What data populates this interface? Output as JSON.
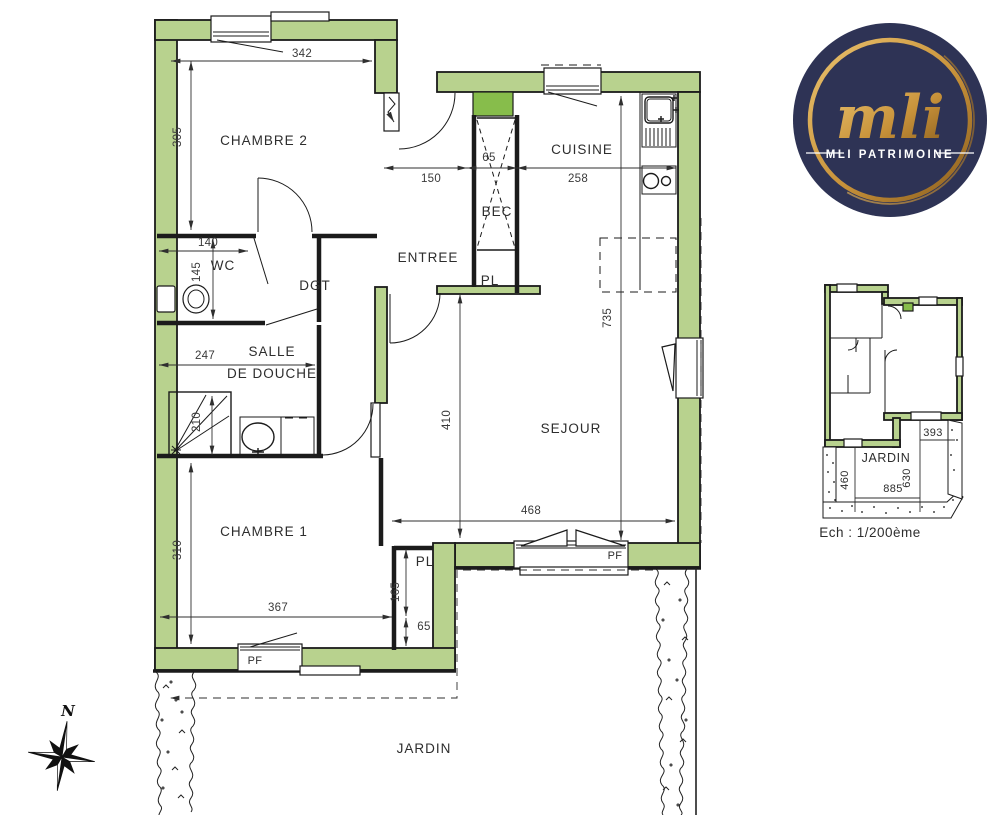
{
  "plan": {
    "rooms": {
      "chambre2": "CHAMBRE 2",
      "wc": "WC",
      "dgt": "DGT",
      "entree": "ENTREE",
      "bec": "BEC",
      "cuisine": "CUISINE",
      "salle": "SALLE",
      "de_douche": "DE DOUCHE",
      "sejour": "SEJOUR",
      "chambre1": "CHAMBRE 1",
      "jardin": "JARDIN"
    },
    "tags": {
      "pl": "PL",
      "pf": "PF"
    },
    "dims": {
      "chambre2_w": "342",
      "chambre2_h": "305",
      "wc_w": "140",
      "wc_h": "145",
      "douche_w": "247",
      "douche_h": "210",
      "entree_w": "150",
      "bec_w": "65",
      "cuisine_w": "258",
      "sejour_h": "735",
      "sejour_west_h": "410",
      "sejour_w": "468",
      "chambre1_h": "310",
      "chambre1_w": "367",
      "pl_h": "165",
      "pl_w": "65"
    }
  },
  "site_plan": {
    "jardin": "JARDIN",
    "garden_w": "393",
    "garden_h_left": "460",
    "garden_h_right": "630",
    "garden_w_bottom": "885",
    "scale": "Ech : 1/200ème"
  },
  "logo": {
    "monogram": "mli",
    "name": "MLI PATRIMOINE"
  },
  "compass": {
    "north": "N"
  },
  "colors": {
    "wall": "#b8d28e",
    "accent": "#87bd4b",
    "line": "#1b1b1b",
    "text": "#2d2d2d",
    "navy": "#2e3355",
    "gold": "#c8923a",
    "gold_light": "#eac26e",
    "gold_dark": "#8a5e1e"
  }
}
